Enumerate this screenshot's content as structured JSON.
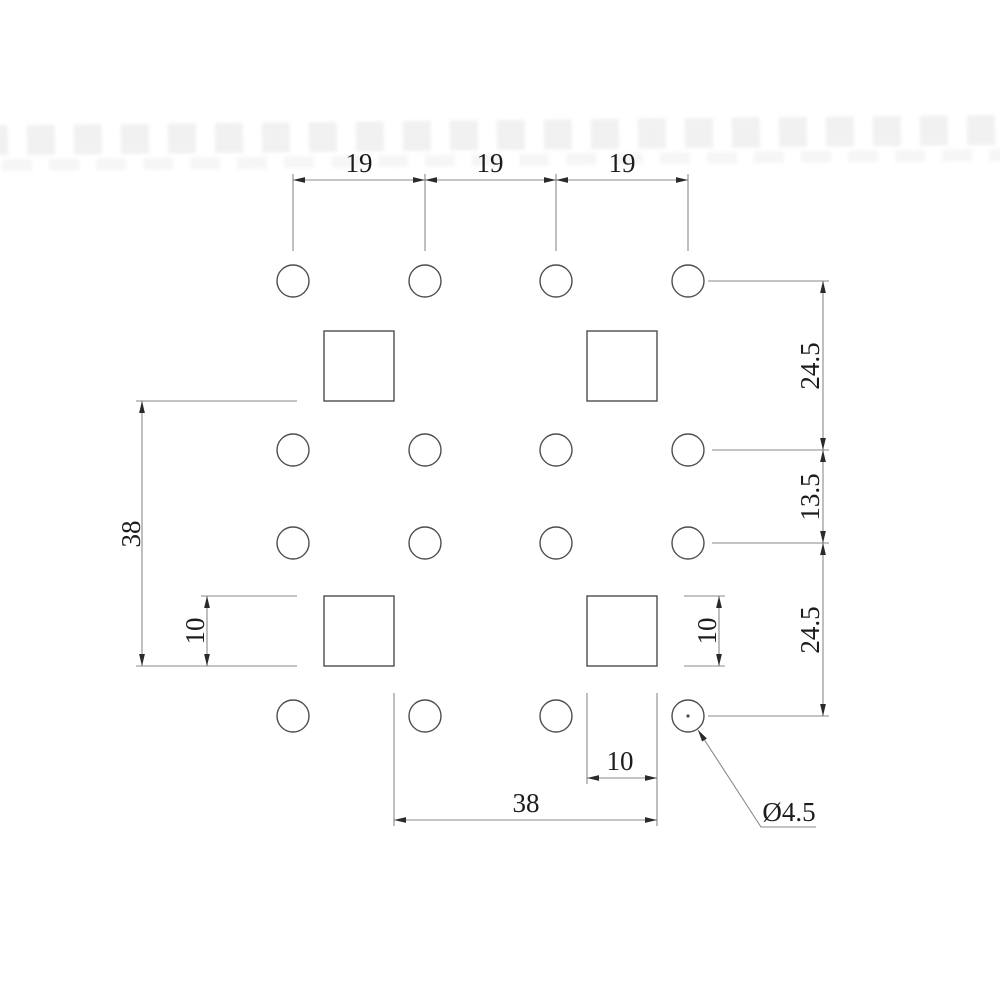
{
  "drawing": {
    "type": "dimensioned-hole-pattern",
    "labels": {
      "top_spacing": [
        "19",
        "19",
        "19"
      ],
      "right_spacing": [
        "24.5",
        "13.5",
        "24.5"
      ],
      "overall_height": "38",
      "overall_width": "38",
      "square_height_left": "10",
      "square_height_right": "10",
      "square_width_bottom": "10",
      "hole_diameter": "Ø4.5"
    },
    "geometry": {
      "hole_grid": {
        "columns": 4,
        "rows": 4,
        "column_spacing": 19,
        "row_spacings": [
          24.5,
          13.5,
          24.5
        ]
      },
      "hole_diameter": 4.5,
      "square_size": 10,
      "overall_width": 38,
      "overall_height": 38
    },
    "colors": {
      "object_line": "#4d4d4d",
      "dimension_line": "#8a8a8a",
      "text": "#1c1c1c",
      "background": "#ffffff"
    }
  }
}
